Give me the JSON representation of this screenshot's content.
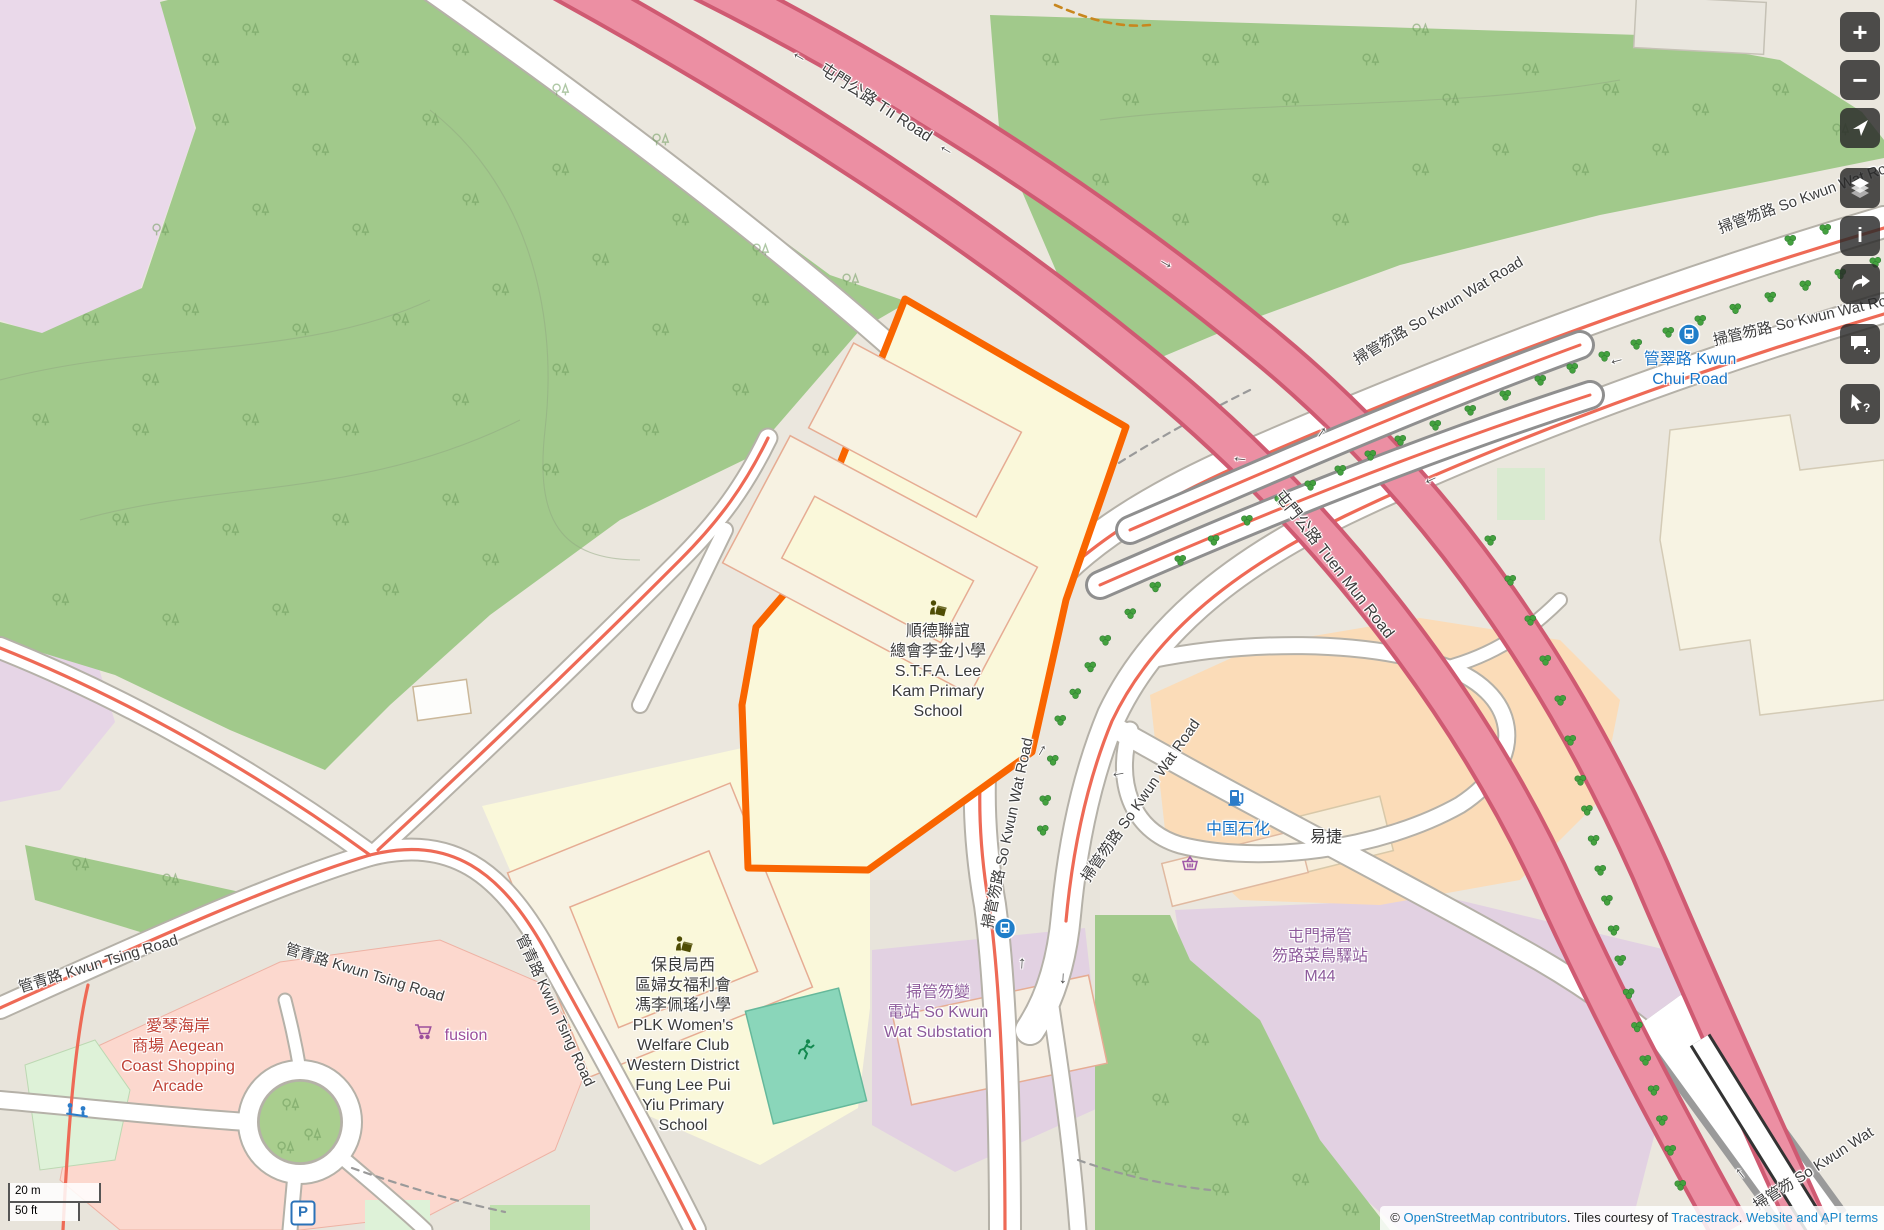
{
  "road_labels": [
    {
      "text": "屯門公路 Tıı Road"
    },
    {
      "text": "屯門公路 Tuen Mun Road"
    },
    {
      "text": "掃管笏路 So Kwun Wat Road"
    },
    {
      "text": "掃管笏路 So Kwun Wat Road"
    },
    {
      "text": "掃管笏路 So Kwun Wat Road"
    },
    {
      "text": "掃管笏路 So Kwun Wat Road"
    },
    {
      "text": "掃管笏路 So Kwun Wat Road"
    },
    {
      "text": "掃管笏 So Kwun Wat"
    },
    {
      "text": "管青路 Kwun Tsing Road"
    },
    {
      "text": "管青路 Kwun Tsing Road"
    },
    {
      "text": "管青路 Kwun Tsing Road"
    }
  ],
  "pois": {
    "stfa_school": {
      "lines": [
        "順德聯誼",
        "總會李金小學",
        "S.T.F.A. Lee",
        "Kam Primary",
        "School"
      ]
    },
    "plk_school": {
      "lines": [
        "保良局西",
        "區婦女福利會",
        "馮李佩瑤小學",
        "PLK Women's",
        "Welfare Club",
        "Western District",
        "Fung Lee Pui",
        "Yiu Primary",
        "School"
      ]
    },
    "substation": {
      "lines": [
        "掃管笏變",
        "電站 So Kwun",
        "Wat Substation"
      ]
    },
    "m44": {
      "lines": [
        "屯門掃管",
        "笏路菜鳥驛站",
        "M44"
      ]
    },
    "arcade": {
      "lines": [
        "愛琴海岸",
        "商場 Aegean",
        "Coast Shopping",
        "Arcade"
      ]
    },
    "fusion": {
      "label": "fusion"
    },
    "sinopec": {
      "label": "中国石化"
    },
    "easyjoy": {
      "label": "易捷"
    },
    "kwun_chui_stop": {
      "lines": [
        "管翠路 Kwun",
        "Chui Road"
      ]
    },
    "parking": {
      "label": "P"
    }
  },
  "controls": [
    {
      "name": "zoom-in",
      "glyph": "+"
    },
    {
      "name": "zoom-out",
      "glyph": "−"
    },
    {
      "name": "locate",
      "glyph": ""
    },
    {
      "name": "layers",
      "glyph": ""
    },
    {
      "name": "legend-info",
      "glyph": "i"
    },
    {
      "name": "share",
      "glyph": ""
    },
    {
      "name": "add-note",
      "glyph": ""
    },
    {
      "name": "query-features",
      "glyph": "?"
    }
  ],
  "scale_bar": {
    "metric": "20 m",
    "imperial": "50 ft"
  },
  "attribution": {
    "prefix": "© ",
    "link_osm": "OpenStreetMap contributors",
    "middle": ". Tiles courtesy of ",
    "link_tracestrack": "Tracestrack",
    "separator": ". ",
    "link_terms": "Website and API terms"
  },
  "arrows": [
    {
      "g": "←",
      "x": 800,
      "y": 55,
      "r": 30
    },
    {
      "g": "←",
      "x": 947,
      "y": 148,
      "r": 30
    },
    {
      "g": "→",
      "x": 1167,
      "y": 262,
      "r": 30
    },
    {
      "g": "↑",
      "x": 1322,
      "y": 432,
      "r": 35
    },
    {
      "g": "←",
      "x": 1240,
      "y": 457,
      "r": 5
    },
    {
      "g": "←",
      "x": 1430,
      "y": 478,
      "r": -25
    },
    {
      "g": "↑",
      "x": 1042,
      "y": 750,
      "r": 30
    },
    {
      "g": "←",
      "x": 1118,
      "y": 772,
      "r": -10
    },
    {
      "g": "↑",
      "x": 1022,
      "y": 963,
      "r": 3
    },
    {
      "g": "↓",
      "x": 1063,
      "y": 978,
      "r": 3
    },
    {
      "g": "←",
      "x": 1616,
      "y": 359,
      "r": -15
    },
    {
      "g": "←",
      "x": 1742,
      "y": 1172,
      "r": 52
    }
  ],
  "colors": {
    "woodland": "#a1c98b",
    "land": "#ebe7de",
    "lavender": "#e2d1e2",
    "school_yellow": "#faf8da",
    "highlight_orange": "#f96500",
    "motorway_fill": "#ec8fa3",
    "motorway_casing": "#cf5a72",
    "retail_pink": "#fcd8ce",
    "commercial_peach": "#fbdcb8",
    "pitch_teal": "#8ad6ba",
    "road_red_line": "#ee6a56",
    "link_blue": "#1686c9",
    "transport_blue": "#1673c7",
    "poi_purple": "#8d5a9b"
  }
}
